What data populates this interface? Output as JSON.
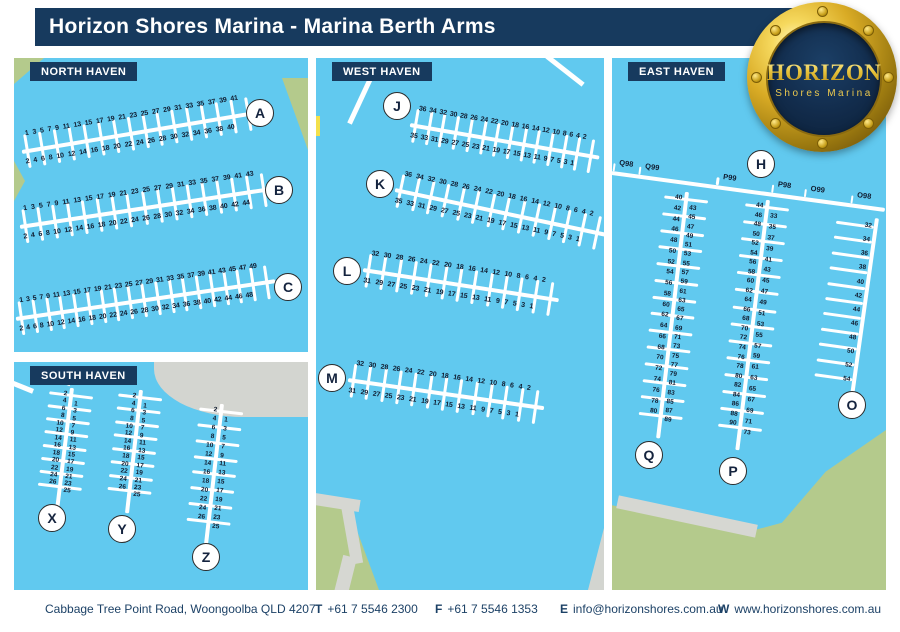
{
  "header": {
    "title": "Horizon Shores Marina - Marina Berth Arms"
  },
  "logo": {
    "name": "HORIZON",
    "tagline": "Shores Marina"
  },
  "panels": [
    {
      "id": "north",
      "label": "NORTH HAVEN"
    },
    {
      "id": "south",
      "label": "SOUTH HAVEN"
    },
    {
      "id": "west",
      "label": "WEST HAVEN"
    },
    {
      "id": "east",
      "label": "EAST HAVEN"
    }
  ],
  "map": {
    "arms": [
      {
        "id": "A",
        "type": "h",
        "x": 22,
        "y": 130,
        "len": 238,
        "angle": -9.5,
        "top": [
          1,
          3,
          5,
          7,
          9,
          11,
          13,
          15,
          17,
          19,
          21,
          23,
          25,
          27,
          29,
          31,
          33,
          35,
          37,
          39,
          41
        ],
        "bottom": [
          2,
          4,
          6,
          8,
          10,
          12,
          14,
          16,
          18,
          20,
          22,
          24,
          26,
          28,
          30,
          32,
          34,
          36,
          38,
          40
        ]
      },
      {
        "id": "B",
        "type": "h",
        "x": 20,
        "y": 205,
        "len": 255,
        "angle": -8.6,
        "top": [
          1,
          3,
          5,
          7,
          9,
          11,
          13,
          15,
          17,
          19,
          21,
          23,
          25,
          27,
          29,
          31,
          33,
          35,
          37,
          39,
          41,
          43
        ],
        "bottom": [
          2,
          4,
          6,
          8,
          10,
          12,
          14,
          16,
          18,
          20,
          22,
          24,
          26,
          28,
          30,
          32,
          34,
          36,
          38,
          40,
          42,
          44
        ]
      },
      {
        "id": "C",
        "type": "h",
        "x": 16,
        "y": 297,
        "len": 262,
        "angle": -8.3,
        "top": [
          1,
          3,
          5,
          7,
          9,
          11,
          13,
          15,
          17,
          19,
          21,
          23,
          25,
          27,
          29,
          31,
          33,
          35,
          37,
          39,
          41,
          43,
          45,
          47,
          49
        ],
        "bottom": [
          2,
          4,
          6,
          8,
          10,
          12,
          14,
          16,
          18,
          20,
          22,
          24,
          26,
          28,
          30,
          32,
          34,
          36,
          38,
          40,
          42,
          44,
          46,
          48
        ]
      },
      {
        "id": "J",
        "type": "h",
        "x": 410,
        "y": 103,
        "len": 192,
        "angle": 9.8,
        "top": [
          36,
          34,
          32,
          30,
          28,
          26,
          24,
          22,
          20,
          18,
          16,
          14,
          12,
          10,
          8,
          6,
          4,
          2
        ],
        "bottom": [
          35,
          33,
          31,
          29,
          27,
          25,
          23,
          21,
          19,
          17,
          15,
          13,
          11,
          9,
          7,
          5,
          3,
          1
        ]
      },
      {
        "id": "K",
        "type": "h",
        "x": 395,
        "y": 168,
        "len": 215,
        "angle": 12,
        "top": [
          36,
          34,
          32,
          30,
          28,
          26,
          24,
          22,
          20,
          18,
          16,
          14,
          12,
          10,
          8,
          6,
          4,
          2
        ],
        "bottom": [
          35,
          33,
          31,
          29,
          27,
          25,
          23,
          21,
          19,
          17,
          15,
          13,
          11,
          9,
          7,
          5,
          3,
          1
        ]
      },
      {
        "id": "L",
        "type": "h",
        "x": 363,
        "y": 248,
        "len": 198,
        "angle": 8.8,
        "top": [
          32,
          30,
          28,
          26,
          24,
          22,
          20,
          18,
          16,
          14,
          12,
          10,
          8,
          6,
          4,
          2
        ],
        "bottom": [
          31,
          29,
          27,
          25,
          23,
          21,
          19,
          17,
          15,
          13,
          11,
          9,
          7,
          5,
          3,
          1
        ]
      },
      {
        "id": "M",
        "type": "h",
        "x": 348,
        "y": 358,
        "len": 198,
        "angle": 8.2,
        "top": [
          32,
          30,
          28,
          26,
          24,
          22,
          20,
          18,
          16,
          14,
          12,
          10,
          8,
          6,
          4,
          2
        ],
        "bottom": [
          31,
          29,
          27,
          25,
          23,
          21,
          19,
          17,
          15,
          13,
          11,
          9,
          7,
          5,
          3,
          1
        ]
      },
      {
        "id": "H",
        "type": "hl",
        "x": 612,
        "y": 154,
        "len": 276,
        "angle": 7.7,
        "labels": [
          {
            "text": "Q98",
            "f": 0.02
          },
          {
            "text": "Q99",
            "f": 0.115
          },
          {
            "text": "P99",
            "f": 0.4
          },
          {
            "text": "P98",
            "f": 0.6
          },
          {
            "text": "O99",
            "f": 0.72
          },
          {
            "text": "O98",
            "f": 0.89
          }
        ]
      },
      {
        "id": "X",
        "type": "v",
        "x": 49,
        "y": 388,
        "len": 122,
        "angle": 7,
        "left": [
          2,
          4,
          6,
          8,
          10,
          12,
          14,
          16,
          18,
          20,
          22,
          24,
          26
        ],
        "right": [
          1,
          3,
          5,
          7,
          9,
          11,
          13,
          15,
          17,
          19,
          21,
          23,
          25
        ]
      },
      {
        "id": "Y",
        "type": "v",
        "x": 118,
        "y": 390,
        "len": 124,
        "angle": 6.5,
        "left": [
          2,
          4,
          6,
          8,
          10,
          12,
          14,
          16,
          18,
          20,
          22,
          24,
          26
        ],
        "right": [
          1,
          3,
          5,
          7,
          9,
          11,
          13,
          15,
          17,
          19,
          21,
          23,
          25
        ]
      },
      {
        "id": "Z",
        "type": "v",
        "x": 199,
        "y": 404,
        "len": 141,
        "angle": 6.5,
        "left": [
          2,
          4,
          6,
          8,
          10,
          12,
          14,
          16,
          18,
          20,
          22,
          24,
          26
        ],
        "right": [
          1,
          3,
          5,
          7,
          9,
          11,
          13,
          15,
          17,
          19,
          21,
          23,
          25
        ]
      },
      {
        "id": "Q",
        "type": "v",
        "x": 664,
        "y": 192,
        "len": 248,
        "angle": 6.7,
        "left": [
          40,
          42,
          44,
          46,
          48,
          50,
          52,
          54,
          56,
          58,
          60,
          62,
          64,
          66,
          68,
          70,
          72,
          74,
          76,
          78,
          80
        ],
        "right": [
          43,
          45,
          47,
          49,
          51,
          53,
          55,
          57,
          59,
          61,
          63,
          65,
          67,
          69,
          71,
          73,
          75,
          77,
          79,
          81,
          83,
          85,
          87,
          89
        ]
      },
      {
        "id": "P",
        "type": "v",
        "x": 745,
        "y": 200,
        "len": 252,
        "angle": 7,
        "left": [
          44,
          46,
          48,
          50,
          52,
          54,
          56,
          58,
          60,
          62,
          64,
          66,
          68,
          70,
          72,
          74,
          76,
          78,
          80,
          82,
          84,
          86,
          88,
          90
        ],
        "right": [
          33,
          35,
          37,
          39,
          41,
          43,
          45,
          47,
          49,
          51,
          53,
          55,
          57,
          59,
          61,
          63,
          65,
          67,
          69,
          71,
          73
        ]
      },
      {
        "id": "O",
        "type": "vl",
        "x": 835,
        "y": 218,
        "len": 178,
        "angle": 8,
        "left": [
          32,
          34,
          36,
          38,
          40,
          42,
          44,
          46,
          48,
          50,
          52,
          54
        ]
      }
    ],
    "markers": [
      {
        "letter": "A",
        "x": 259,
        "y": 112
      },
      {
        "letter": "B",
        "x": 278,
        "y": 189
      },
      {
        "letter": "C",
        "x": 287,
        "y": 286
      },
      {
        "letter": "J",
        "x": 396,
        "y": 105
      },
      {
        "letter": "K",
        "x": 379,
        "y": 183
      },
      {
        "letter": "L",
        "x": 346,
        "y": 270
      },
      {
        "letter": "M",
        "x": 331,
        "y": 377
      },
      {
        "letter": "H",
        "x": 760,
        "y": 163
      },
      {
        "letter": "Q",
        "x": 648,
        "y": 454
      },
      {
        "letter": "P",
        "x": 732,
        "y": 470
      },
      {
        "letter": "O",
        "x": 851,
        "y": 404
      },
      {
        "letter": "X",
        "x": 51,
        "y": 517
      },
      {
        "letter": "Y",
        "x": 121,
        "y": 528
      },
      {
        "letter": "Z",
        "x": 205,
        "y": 556
      }
    ]
  },
  "footer": {
    "address": "Cabbage Tree Point Road, Woongoolba QLD 4207",
    "items": [
      {
        "label": "T",
        "value": "+61 7 5546 2300"
      },
      {
        "label": "F",
        "value": "+61 7 5546 1353"
      },
      {
        "label": "E",
        "value": "info@horizonshores.com.au"
      },
      {
        "label": "W",
        "value": "www.horizonshores.com.au"
      }
    ]
  },
  "colors": {
    "navy": "#173a5e",
    "water": "#61c9ef",
    "land": "#b4ca8c",
    "road": "#d6d7d2",
    "gray_land": "#d3d5d0",
    "number_text": "#101c30",
    "marker_border": "#2b2b2b",
    "logo_gold": "#ecc94e"
  }
}
